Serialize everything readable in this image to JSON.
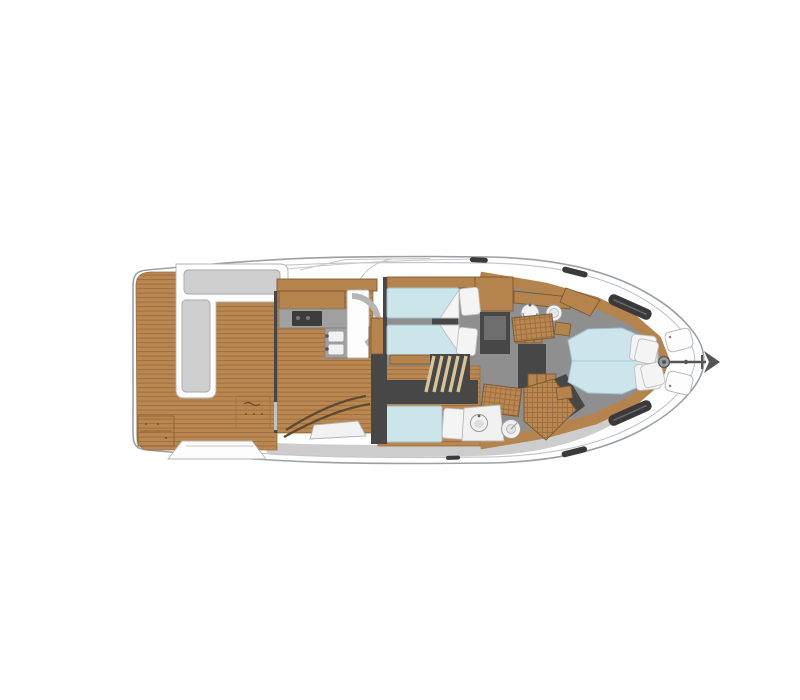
{
  "title": "Motor yacht deck plan - overhead view",
  "colors": {
    "bg": "#ffffff",
    "deck": "#ffffff",
    "hull-stroke": "#9aa0a6",
    "hull-inner": "#c4c7ca",
    "walkway": "#cdcdcd",
    "teak": "#bb8751",
    "teak-line": "#9c7040",
    "wood": "#b5834c",
    "wood-edge": "#7d5a33",
    "floor": "#8f8f8f",
    "wall": "#474747",
    "wall-light": "#6e6e6e",
    "counter": "#a0a0a0",
    "appliance": "#3c3c3c",
    "bed": "#cbe5eb",
    "bed-stroke": "#9fc2ca",
    "bed-crease": "#aed0d8",
    "linen": "#f4f4f4",
    "fixture": "#f1f1f1",
    "fixture-stroke": "#9a9a9a",
    "bench": "#cfcfcf",
    "bench-edge": "#a8a8a8",
    "metal": "#555555",
    "glass-dark": "#3a3a3a",
    "line-light": "#c8c8c8",
    "table": "#f2f2f2"
  },
  "plan": {
    "vessel": "flybridge motor yacht",
    "view": "overhead deck plan, stern at left, bow at right",
    "areas": [
      {
        "id": "cockpit",
        "label": "Aft cockpit with teak deck"
      },
      {
        "id": "cockpit-settee",
        "label": "L-shaped cockpit settee"
      },
      {
        "id": "salon-galley",
        "label": "Salon and galley with L-shaped counter"
      },
      {
        "id": "dinette",
        "label": "Curved dinette seat and table"
      },
      {
        "id": "twin-cabin",
        "label": "Twin guest cabin with two berths"
      },
      {
        "id": "single-cabin",
        "label": "Single guest berth cabin"
      },
      {
        "id": "forward-head",
        "label": "Forward head with basin, toilet and shower grate"
      },
      {
        "id": "mid-head",
        "label": "Mid head with corner basin, toilet and shower grate"
      },
      {
        "id": "master-cabin",
        "label": "Owner's cabin with island berth"
      },
      {
        "id": "corridor",
        "label": "Lower-deck corridor and companionway stairs"
      },
      {
        "id": "bow-deck",
        "label": "Foredeck with hatches, windlass and anchor"
      },
      {
        "id": "side-decks",
        "label": "Side walkways and boarding step"
      }
    ],
    "fixtures": [
      "settee-cushions",
      "cockpit-table",
      "transom-locker-steps",
      "boarding-step",
      "galley-upper-cabinet",
      "galley-counter",
      "cooktop",
      "double-sink",
      "refrigerator-column",
      "dinette-table",
      "companionway-stairs",
      "twin-berth-1",
      "twin-berth-2",
      "berth-pillows",
      "wardrobe",
      "washbasin-forward",
      "toilet-forward",
      "shower-grate-forward",
      "washbasin-mid",
      "toilet-mid",
      "shower-grate-mid",
      "single-berth",
      "island-double-berth",
      "master-pillows",
      "deck-hatch-1",
      "deck-hatch-2",
      "windlass",
      "anchor",
      "hull-window-port",
      "hull-window-starboard",
      "cleats"
    ]
  }
}
